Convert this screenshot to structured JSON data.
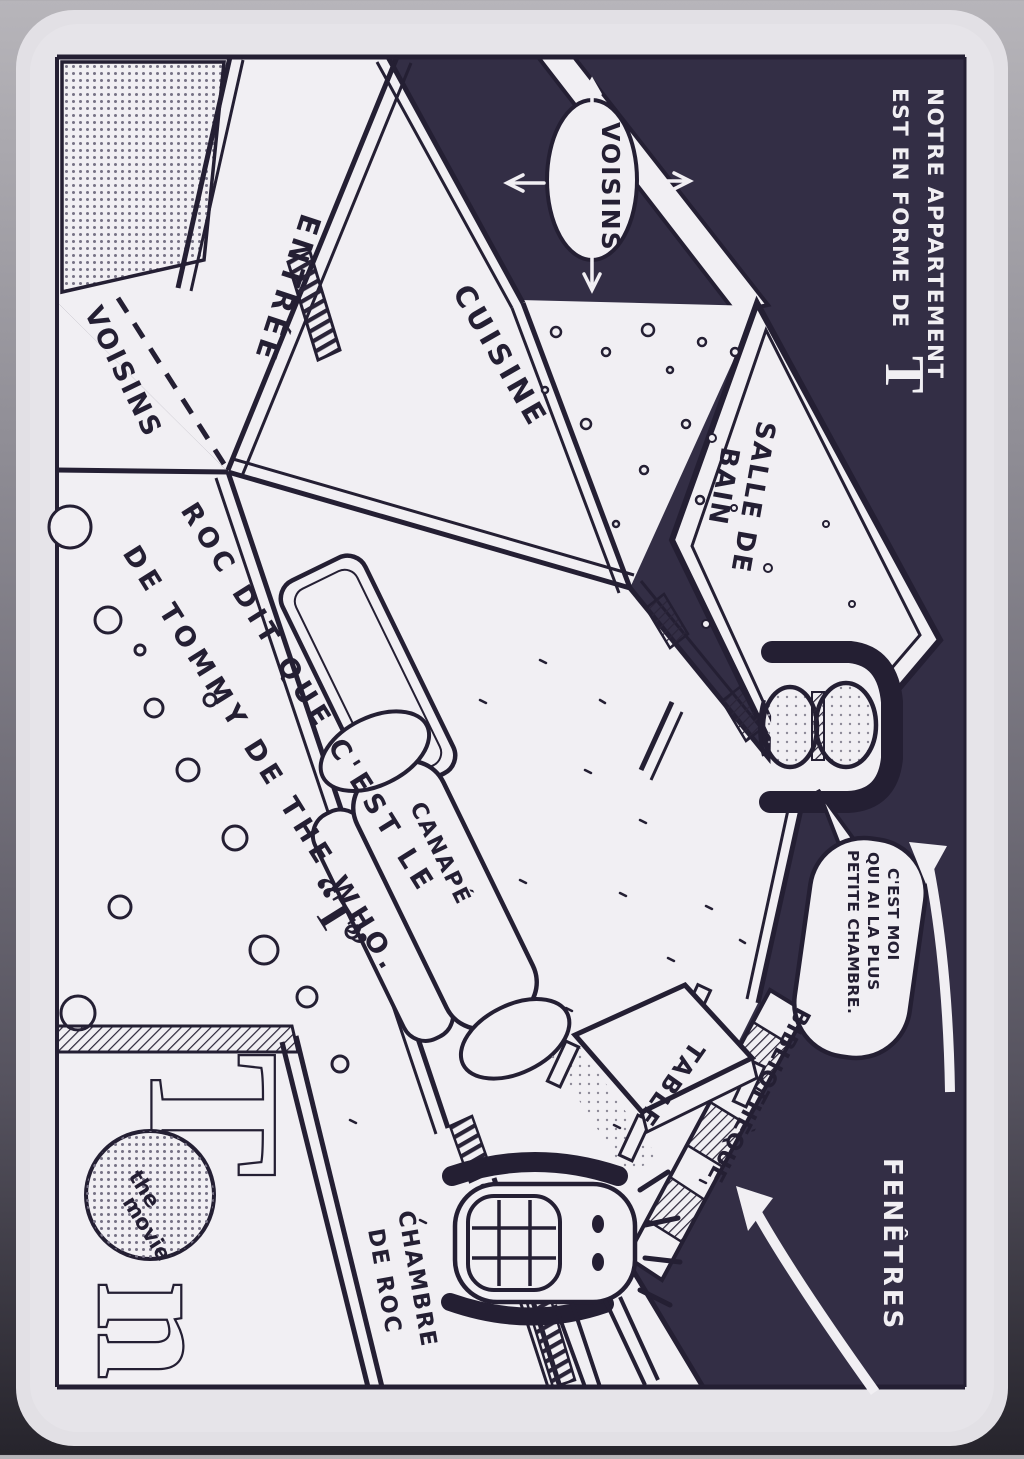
{
  "title": {
    "line1": "NOTRE APPARTEMENT",
    "line2": "EST EN FORME DE",
    "letter": "T"
  },
  "neighbors": {
    "bubble": "VOISINS",
    "side_label": "VOISINS"
  },
  "rooms": {
    "entree": "ENTRÉE",
    "cuisine": "CUISINE",
    "salle_de_bain_line1": "SALLE DE",
    "salle_de_bain_line2": "BAIN",
    "chambre_line1": "CHAMBRE",
    "chambre_line2": "DE ROC"
  },
  "furniture": {
    "canape": "CANAPÉ",
    "table": "TABLE",
    "bibliotheque": "BIBLIOTHÈQUE"
  },
  "caption": {
    "line1": "ROC DIT QUE C'EST LE",
    "t": "“T”",
    "line2": "DE TOMMY DE THE WHO."
  },
  "speech": {
    "line1": "C'EST MOI",
    "line2": "QUI AI LA PLUS",
    "line3": "PETITE CHAMBRE."
  },
  "windows_label": "FENÊTRES",
  "poster": {
    "letter_top": "T",
    "movie_line1": "the",
    "movie_line2": "movie",
    "letter_bottom": "n"
  },
  "colors": {
    "ink": "#241f33",
    "dark_bg": "#332e45",
    "paper": "#f1eff3",
    "page": "#e2e0e5"
  }
}
